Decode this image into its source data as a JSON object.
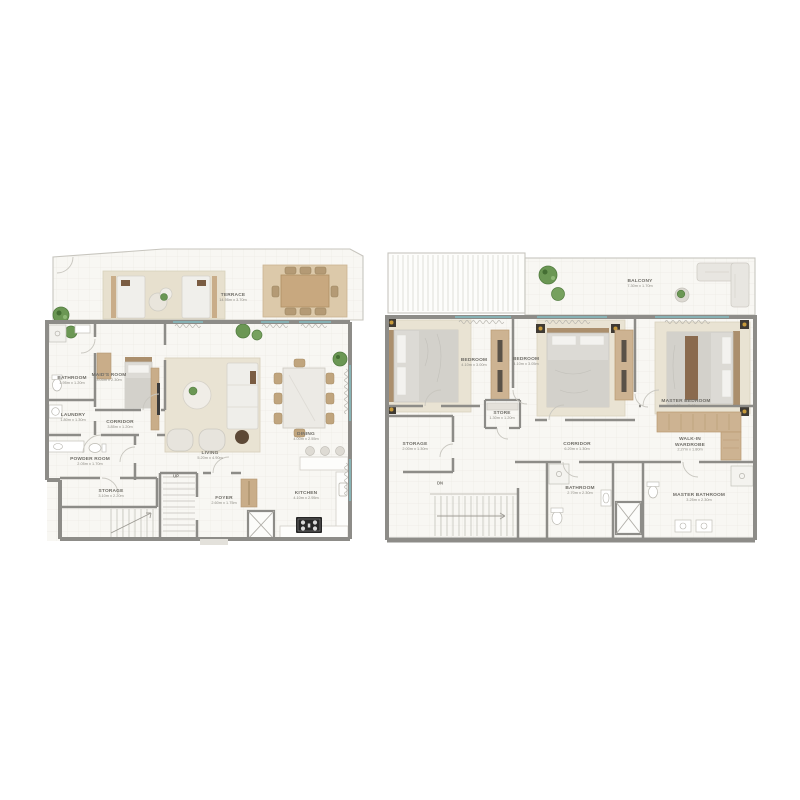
{
  "title": "Duplex apartment floor plans (lower and upper level)",
  "colors": {
    "wall": "#8d8c88",
    "floor": "#f8f7f3",
    "wood_accent": "#cdb392",
    "rug": "#e9e3d3",
    "plant_green": "#6b9754",
    "window_glass": "#86b6ba",
    "label_text": "#6e6c66",
    "stove_black": "#262626"
  },
  "plans": {
    "left": {
      "id": "lower-level-plan",
      "stair_label": "UP",
      "rooms": {
        "terrace": {
          "name": "TERRACE",
          "dims": "14.95m x 3.70m"
        },
        "bathroom": {
          "name": "BATHROOM",
          "dims": "1.95m x 1.20m"
        },
        "maids_room": {
          "name": "MAID'S ROOM",
          "dims": "3.05m x 2.30m"
        },
        "laundry": {
          "name": "LAUNDRY",
          "dims": "1.80m x 1.30m"
        },
        "corridor": {
          "name": "CORRIDOR",
          "dims": "3.85m x 1.20m"
        },
        "powder_room": {
          "name": "POWDER ROOM",
          "dims": "2.05m x 1.70m"
        },
        "storage": {
          "name": "STORAGE",
          "dims": "3.10m x 2.20m"
        },
        "living": {
          "name": "LIVING",
          "dims": "5.20m x 4.90m"
        },
        "dining": {
          "name": "DINING",
          "dims": "4.00m x 2.55m"
        },
        "foyer": {
          "name": "FOYER",
          "dims": "2.60m x 1.75m"
        },
        "kitchen": {
          "name": "KITCHEN",
          "dims": "4.10m x 2.95m"
        }
      }
    },
    "right": {
      "id": "upper-level-plan",
      "stair_label": "DN",
      "rooms": {
        "balcony": {
          "name": "BALCONY",
          "dims": "7.30m x 1.70m"
        },
        "bedroom_1": {
          "name": "BEDROOM",
          "dims": "4.10m x 3.00m"
        },
        "bedroom_2": {
          "name": "BEDROOM",
          "dims": "4.10m x 3.05m"
        },
        "master_bedroom": {
          "name": "MASTER BEDROOM",
          "dims": "4.15m x 3.40m"
        },
        "store": {
          "name": "STORE",
          "dims": "1.30m x 1.20m"
        },
        "storage": {
          "name": "STORAGE",
          "dims": "2.00m x 1.30m"
        },
        "corridor": {
          "name": "CORRIDOR",
          "dims": "6.20m x 1.30m"
        },
        "walk_in_wardrobe": {
          "name": "WALK-IN WARDROBE",
          "dims": "2.27m x 1.80m"
        },
        "bathroom": {
          "name": "BATHROOM",
          "dims": "2.70m x 2.30m"
        },
        "master_bathroom": {
          "name": "MASTER BATHROOM",
          "dims": "3.25m x 2.30m"
        }
      }
    }
  }
}
